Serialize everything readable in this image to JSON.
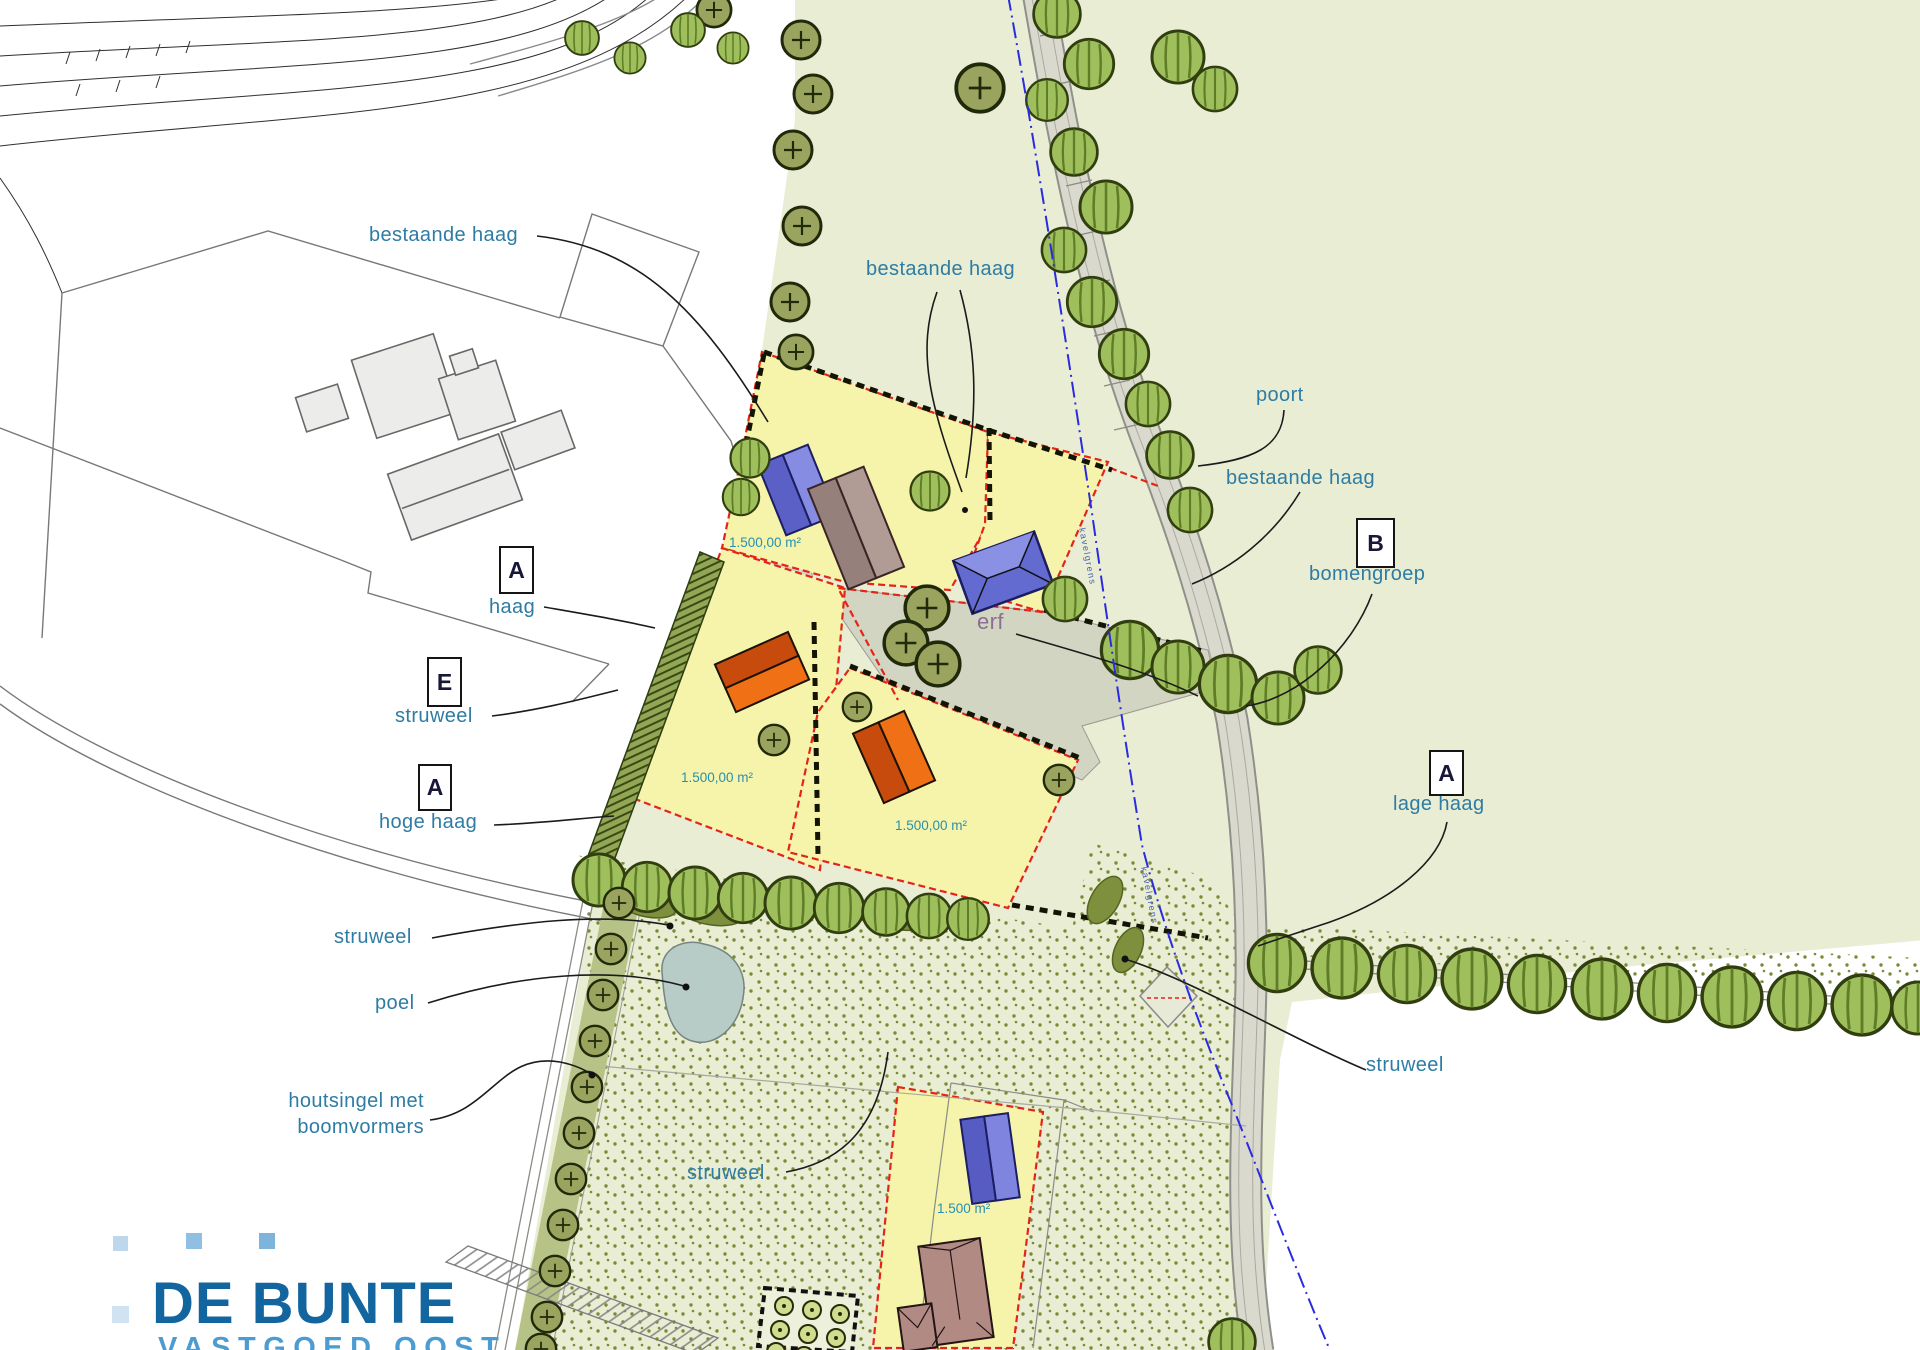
{
  "map": {
    "annotations": {
      "bestaande_haag_nw": "bestaande haag",
      "bestaande_haag_mid": "bestaande haag",
      "poort": "poort",
      "bestaande_haag_e": "bestaande haag",
      "bomengroep": "bomengroep",
      "haag": "haag",
      "struweel_w": "struweel",
      "hoge_haag": "hoge haag",
      "lage_haag": "lage haag",
      "erf": "erf",
      "struweel_sw": "struweel",
      "poel": "poel",
      "houtsingel_line1": "houtsingel met",
      "houtsingel_line2": "boomvormers",
      "struweel_s": "struweel",
      "struweel_se": "struweel",
      "kavelgrens_n": "kavelgrens",
      "kavelgrens_s": "kavelgrens"
    },
    "badges": {
      "haag_a": "A",
      "struweel_e": "E",
      "hoge_haag_a": "A",
      "bomengroep_b": "B",
      "lage_haag_a": "A"
    },
    "plot_areas": {
      "nw": "1.500,00 m²",
      "w": "1.500,00 m²",
      "s": "1.500,00 m²",
      "south": "1.500 m²"
    }
  },
  "logo": {
    "title": "DE BUNTE",
    "subtitle": "VASTGOED OOST"
  },
  "palette": {
    "field_green": "#e8edd4",
    "plot_yellow": "#f5f4aa",
    "plot_border_red": "#e42418",
    "hedge_black": "#141405",
    "erf_gray": "#d3d5c3",
    "lane_gray": "#d9d9cd",
    "water_gray_blue": "#b7cbc7",
    "tree_bright_green": "#9ebf5c",
    "tree_olive": "#9aa45e",
    "label_teal": "#2e7ca3",
    "erf_label_mauve": "#8c6f92",
    "boundary_blue": "#2b2be0",
    "logo_blue": "#12659e",
    "logo_light_blue": "#4c9cd1"
  }
}
